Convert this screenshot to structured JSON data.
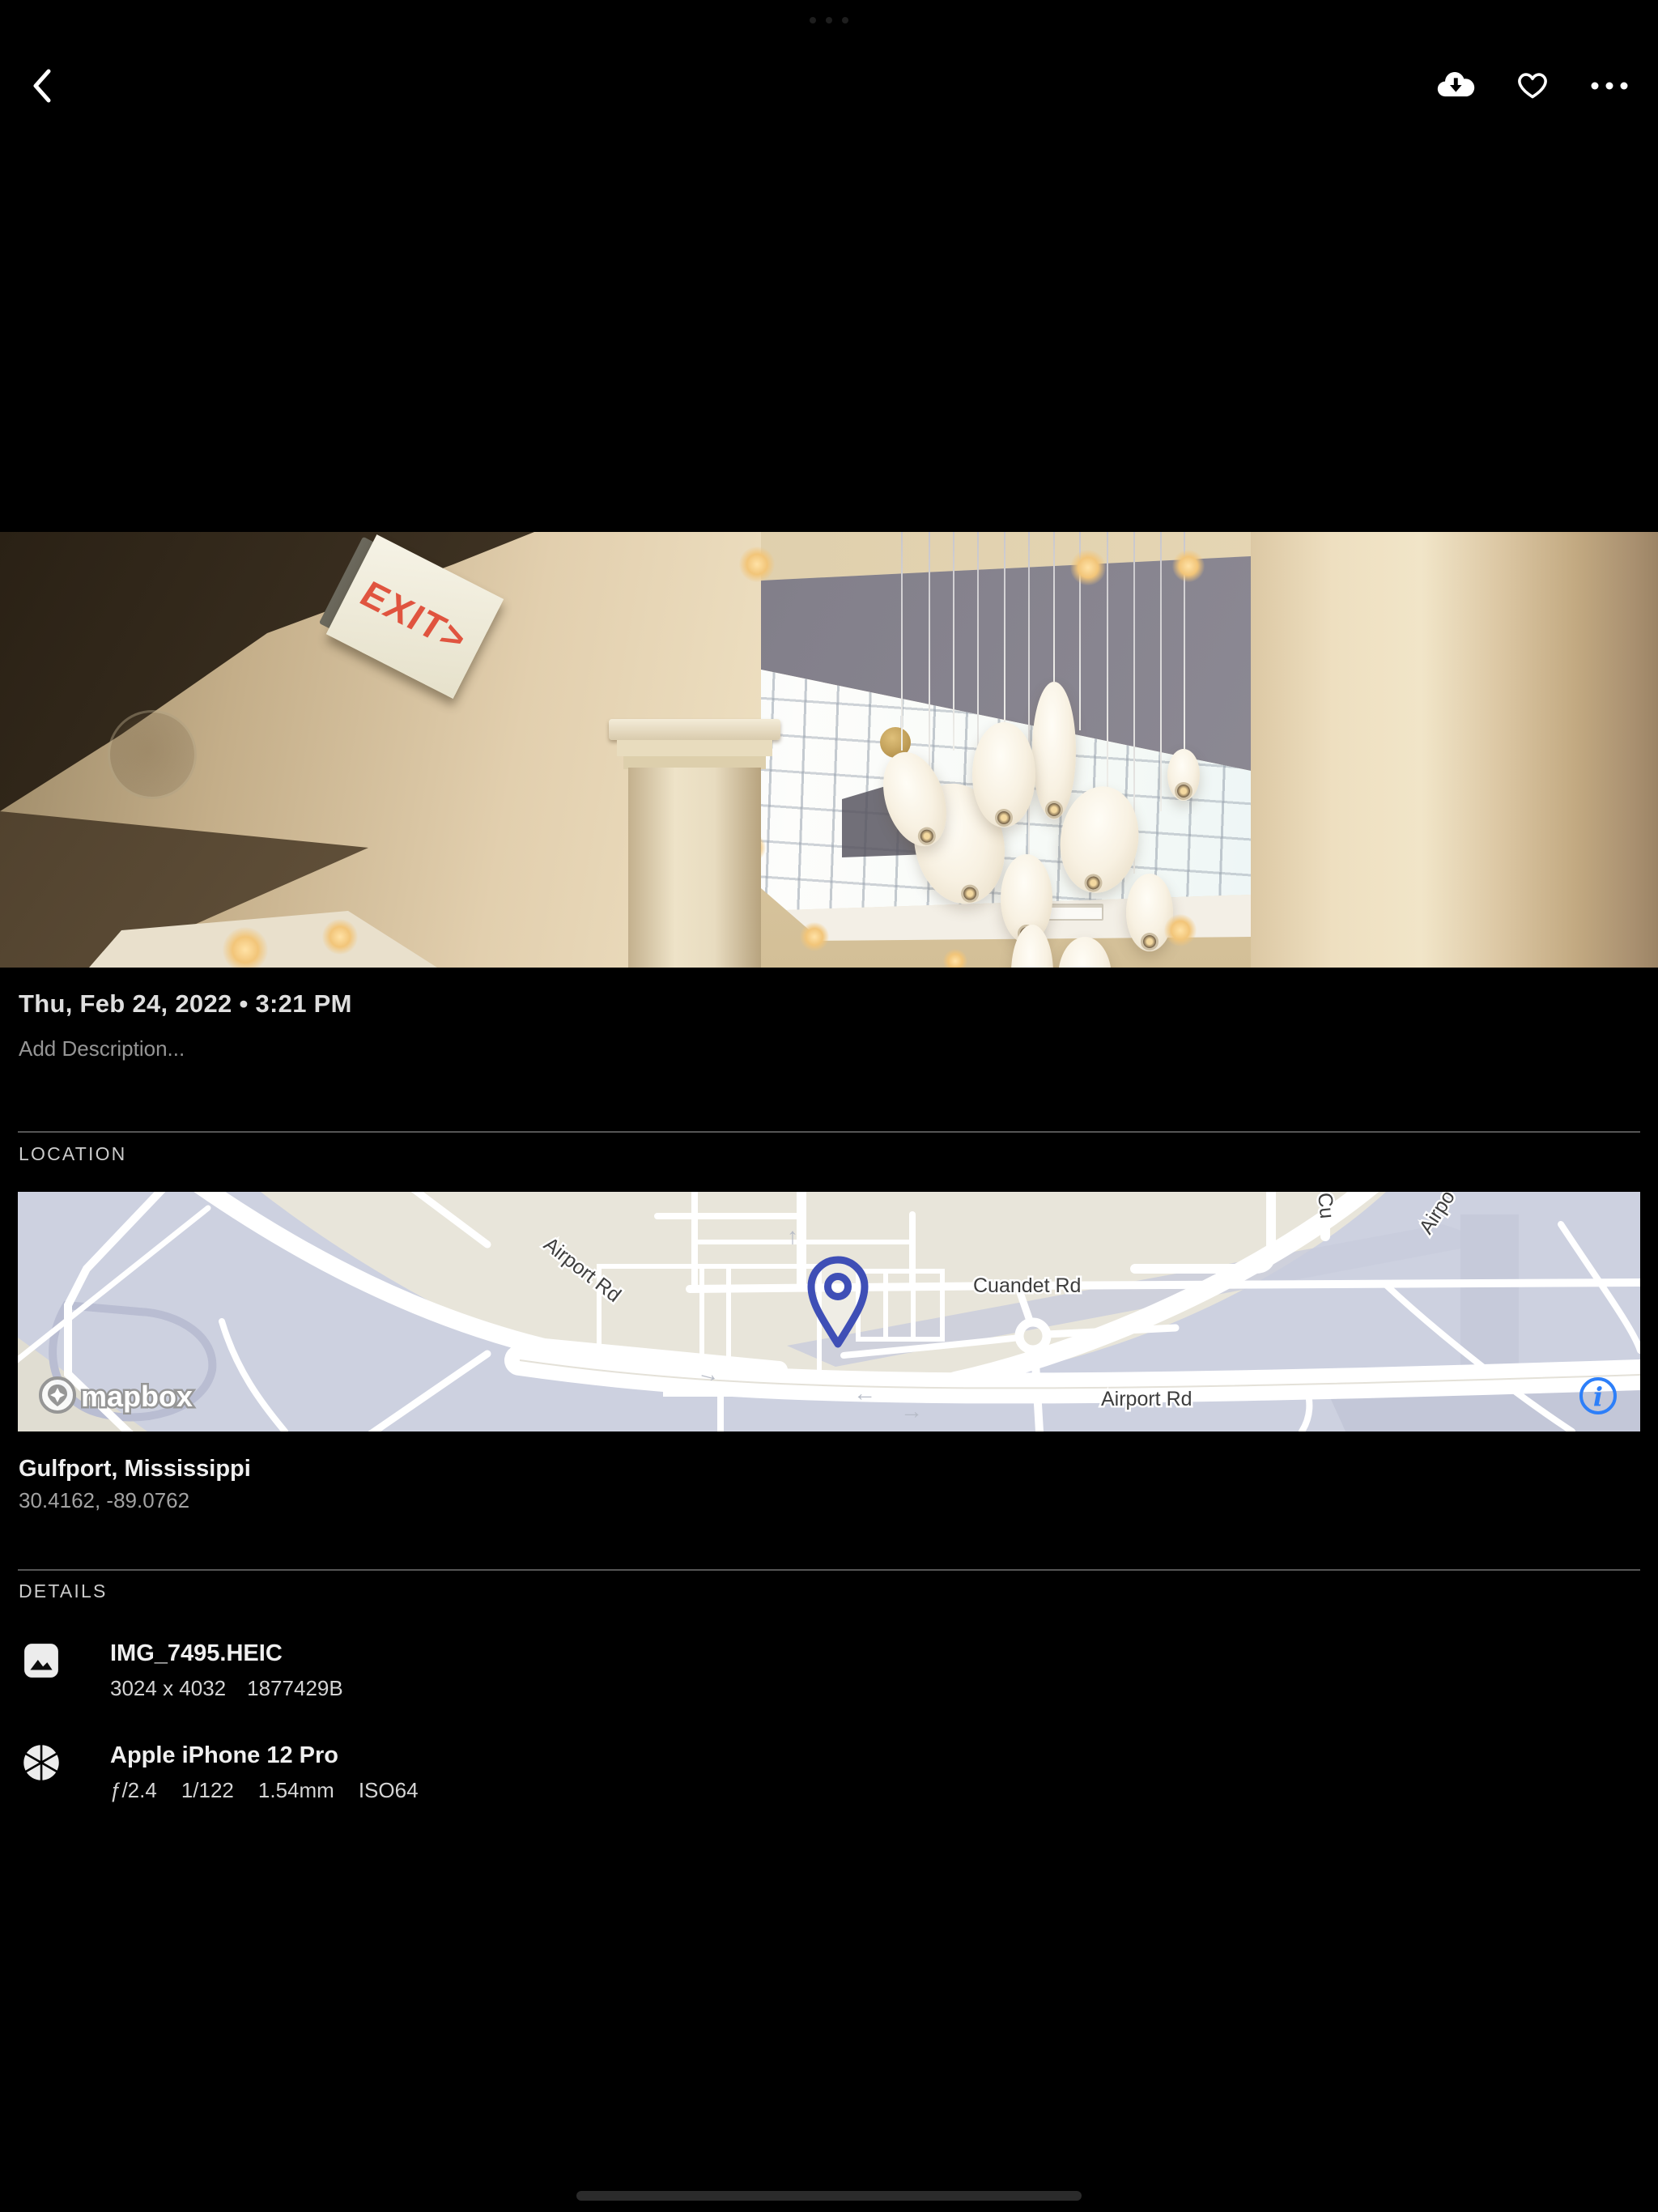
{
  "colors": {
    "background": "#000000",
    "accent_blue": "#2d7ff9",
    "pin_blue": "#3f4fb6",
    "map_land_beige": "#e8e5da",
    "map_field_lavender": "#cdd1e0",
    "divider": "#555555",
    "exit_sign_red": "#e0543f",
    "text_primary": "#efefef",
    "text_secondary": "#a2a2a2"
  },
  "toolbar": {
    "icons": [
      "back-chevron",
      "cloud-download",
      "heart-outline",
      "ellipsis-horizontal"
    ]
  },
  "photo": {
    "exit_sign_text": "EXIT>"
  },
  "info": {
    "date": "Thu, Feb 24, 2022 • 3:21 PM",
    "description_placeholder": "Add Description..."
  },
  "location": {
    "header": "LOCATION",
    "place": "Gulfport, Mississippi",
    "coordinates": "30.4162, -89.0762",
    "map": {
      "labels": {
        "airport_upper": "Airport Rd",
        "cuandet": "Cuandet Rd",
        "airport_lower": "Airport Rd",
        "partial_cu": "Cu",
        "partial_airport": "Airpo"
      },
      "arrows": [
        "←",
        "→",
        "↑",
        "→"
      ],
      "attribution": "mapbox",
      "info_glyph": "i"
    }
  },
  "details": {
    "header": "DETAILS",
    "file": {
      "name": "IMG_7495.HEIC",
      "dimensions": "3024 x 4032",
      "size": "1877429B"
    },
    "camera": {
      "name": "Apple iPhone 12 Pro",
      "aperture": "ƒ/2.4",
      "shutter": "1/122",
      "focal": "1.54mm",
      "iso": "ISO64"
    }
  }
}
